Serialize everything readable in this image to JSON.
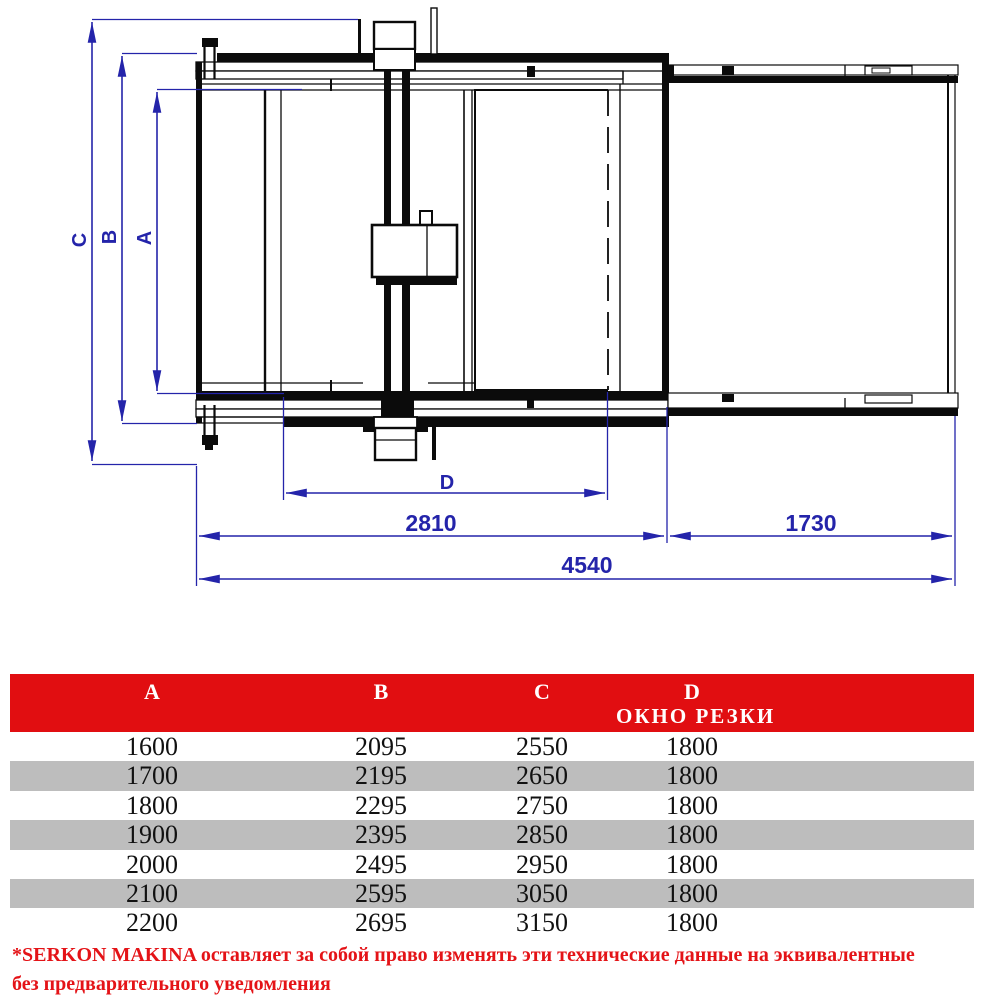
{
  "drawing": {
    "dim_c": "C",
    "dim_b": "B",
    "dim_a": "A",
    "dim_d": "D",
    "dim_main_width": "2810",
    "dim_ext_width": "1730",
    "dim_total_width": "4540"
  },
  "table": {
    "col_a": "A",
    "col_b": "B",
    "col_c": "C",
    "col_d": "D",
    "col_d_sub": "ОКНО РЕЗКИ",
    "rows": [
      [
        "1600",
        "2095",
        "2550",
        "1800"
      ],
      [
        "1700",
        "2195",
        "2650",
        "1800"
      ],
      [
        "1800",
        "2295",
        "2750",
        "1800"
      ],
      [
        "1900",
        "2395",
        "2850",
        "1800"
      ],
      [
        "2000",
        "2495",
        "2950",
        "1800"
      ],
      [
        "2100",
        "2595",
        "3050",
        "1800"
      ],
      [
        "2200",
        "2695",
        "3150",
        "1800"
      ]
    ]
  },
  "footer": {
    "note_line1": "*SERKON MAKINA оставляет за собой право изменять эти технические данные на эквивалентные",
    "note_line2": "без предварительного уведомления"
  },
  "colors": {
    "dimension_blue": "#2424aa",
    "header_red": "#e10e11",
    "stripe_gray": "#bdbdbd",
    "footer_red": "#e41317",
    "line_black": "#0b0b0b"
  }
}
